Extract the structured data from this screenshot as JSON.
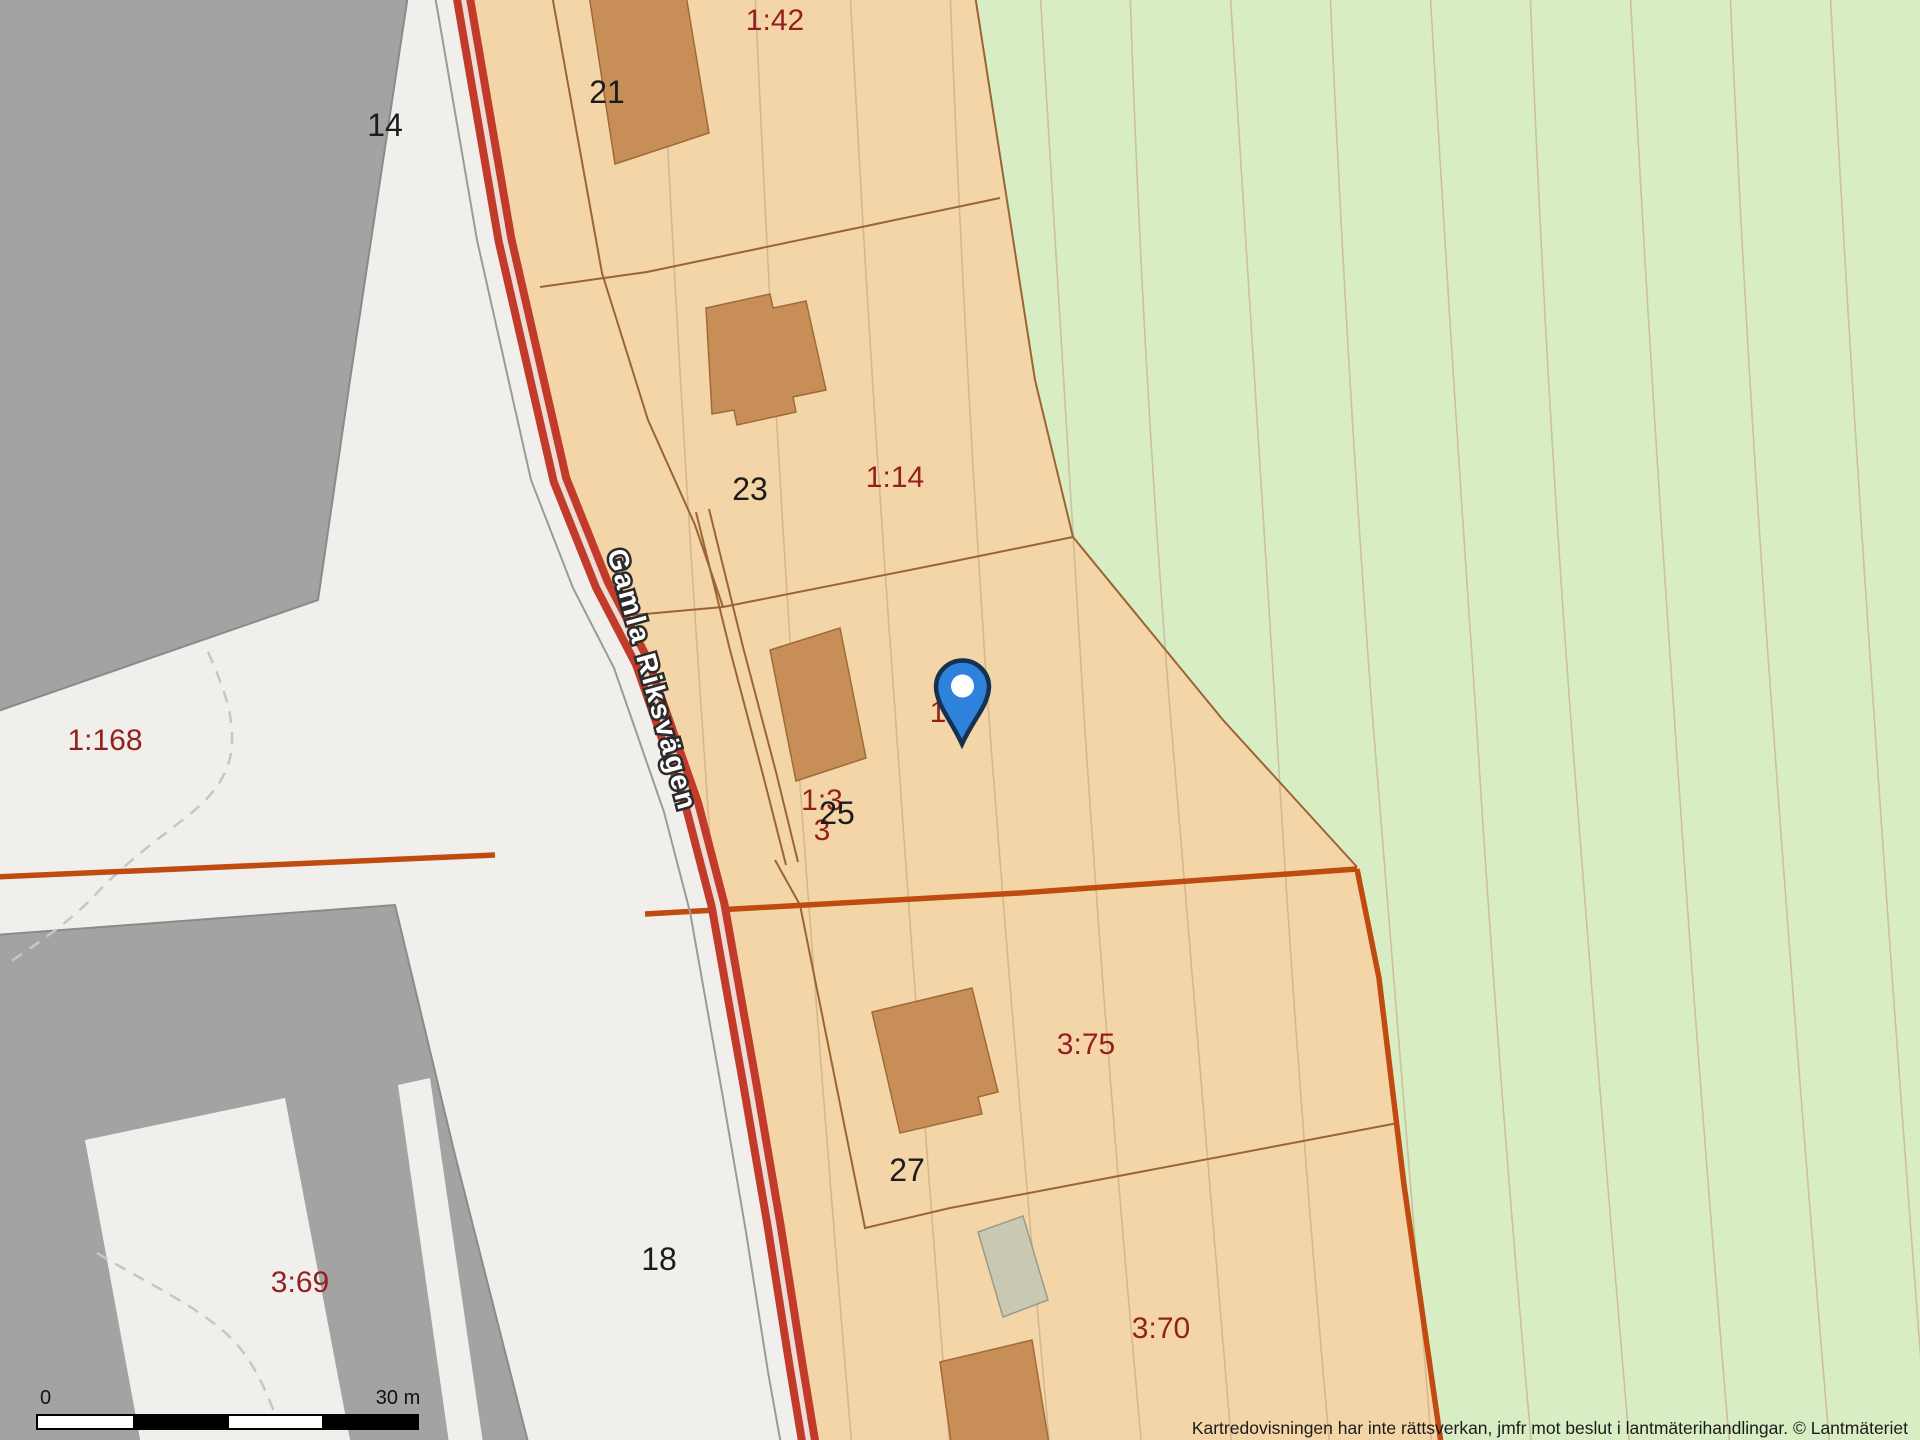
{
  "map": {
    "road_name": "Gamla Riksvägen",
    "disclaimer": "Kartredovisningen har inte rättsverkan, jmfr mot beslut i lantmäterihandlingar. © Lantmäteriet",
    "scale_bar": {
      "left_label": "0",
      "right_label": "30 m"
    },
    "pin": {
      "x": 962,
      "y": 686
    },
    "parcel_labels": [
      {
        "text": "1:42",
        "x": 775,
        "y": 30
      },
      {
        "text": "1:14",
        "x": 895,
        "y": 487
      },
      {
        "text": "1:168",
        "x": 105,
        "y": 750
      },
      {
        "text": "1:3",
        "x": 822,
        "y": 810
      },
      {
        "text": "3",
        "x": 822,
        "y": 840
      },
      {
        "text": "1",
        "x": 938,
        "y": 722
      },
      {
        "text": "3:75",
        "x": 1086,
        "y": 1054
      },
      {
        "text": "3:70",
        "x": 1161,
        "y": 1338
      },
      {
        "text": "3:69",
        "x": 300,
        "y": 1292
      }
    ],
    "address_labels": [
      {
        "text": "14",
        "x": 385,
        "y": 136
      },
      {
        "text": "21",
        "x": 607,
        "y": 103
      },
      {
        "text": "23",
        "x": 750,
        "y": 500
      },
      {
        "text": "25",
        "x": 837,
        "y": 824
      },
      {
        "text": "27",
        "x": 907,
        "y": 1181
      },
      {
        "text": "18",
        "x": 659,
        "y": 1270
      }
    ],
    "colors": {
      "white_bg": "#f1efec",
      "orange_parcel": "#f4d5a7",
      "green_area": "#d9edc4",
      "gray_building": "#a3a3a3",
      "gray_building_border": "#8a8a8a",
      "brown_building": "#c78e58",
      "brown_building_border": "#a06a38",
      "beige_building": "#c9c9b2",
      "road_red": "#c23b2a",
      "road_center": "#ecddd6",
      "boundary_thick": "#bf4b10",
      "boundary_thin": "#9b6434",
      "contour": "#c2a486",
      "dashed_line": "#c6c6c6",
      "label_red": "#941f1f",
      "label_black": "#1c1c1c",
      "pin_blue": "#2f82dc",
      "pin_outline": "#16304f"
    }
  }
}
